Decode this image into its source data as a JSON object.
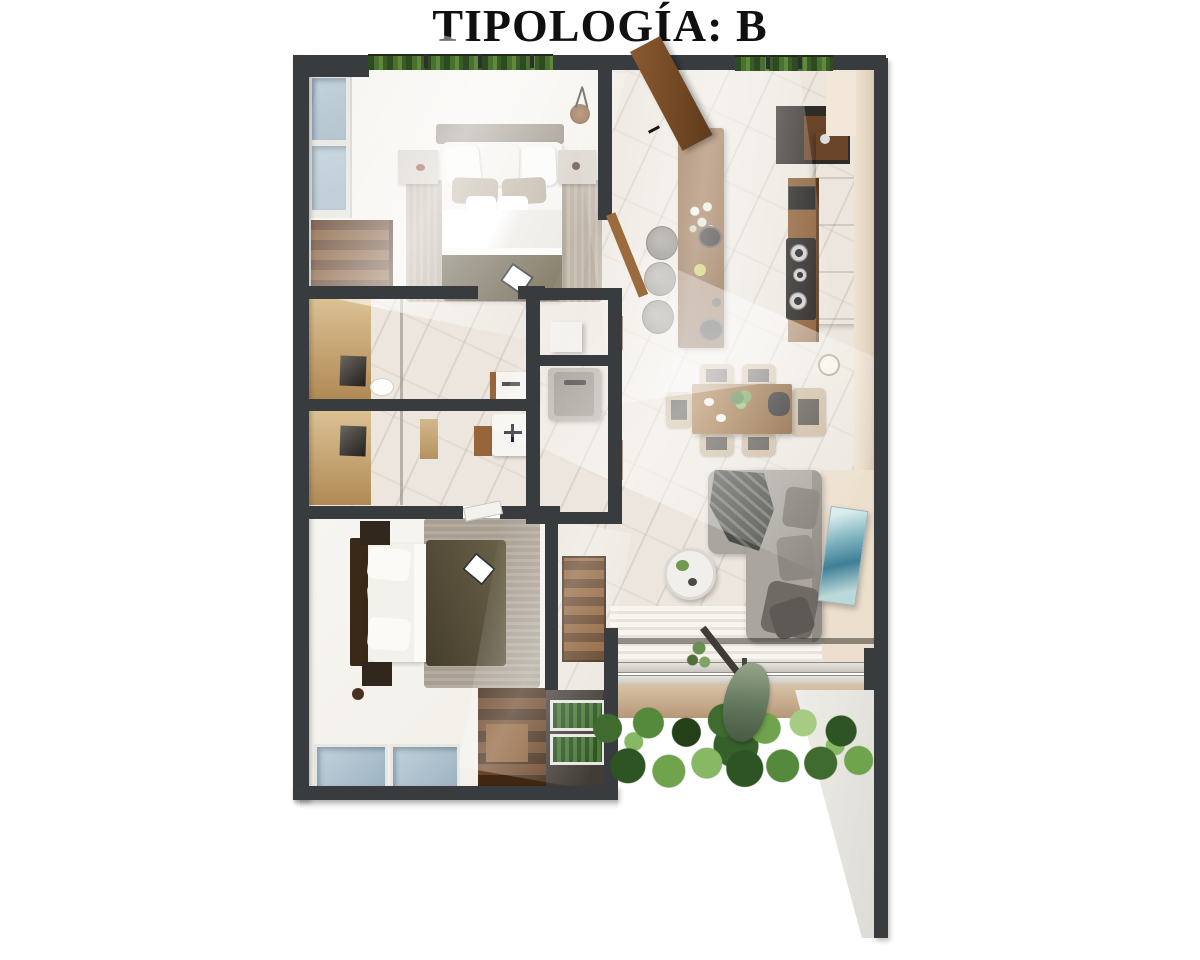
{
  "title": "TIPOLOGÍA: B",
  "palette": {
    "wall": "#383c3e",
    "wallDark": "#2c3030",
    "floor": "#f2efe8",
    "marble": "#ece6de",
    "wood": "#8a5c33",
    "woodDark": "#5d3a1e",
    "woodDeep": "#422614",
    "tanLight": "#dcc193",
    "tanDark": "#b08a55",
    "blueLight": "#c2d2dc",
    "blueDark": "#9db3c2",
    "olive": "#6e6550",
    "oliveDark": "#544c38",
    "sofa": "#aaa69f",
    "sofaShadow": "#6f6b64",
    "beigeWall": "#ecdfcd",
    "grayCounter": "#ccc7c0",
    "rug": "#b6aa9b",
    "rugDark": "#a89e91",
    "deckLight": "#f8f5f0",
    "deckDark": "#e7e2da",
    "greenDeep": "#2e5423",
    "greenMid": "#4c7a3a",
    "greenLight": "#87b863",
    "artTeal": "#7fb3c0",
    "artDeep": "#3f7f97",
    "linen": "#f6f4f0",
    "seatDark": "#4d4840",
    "chairBeige": "#cbb79b"
  }
}
